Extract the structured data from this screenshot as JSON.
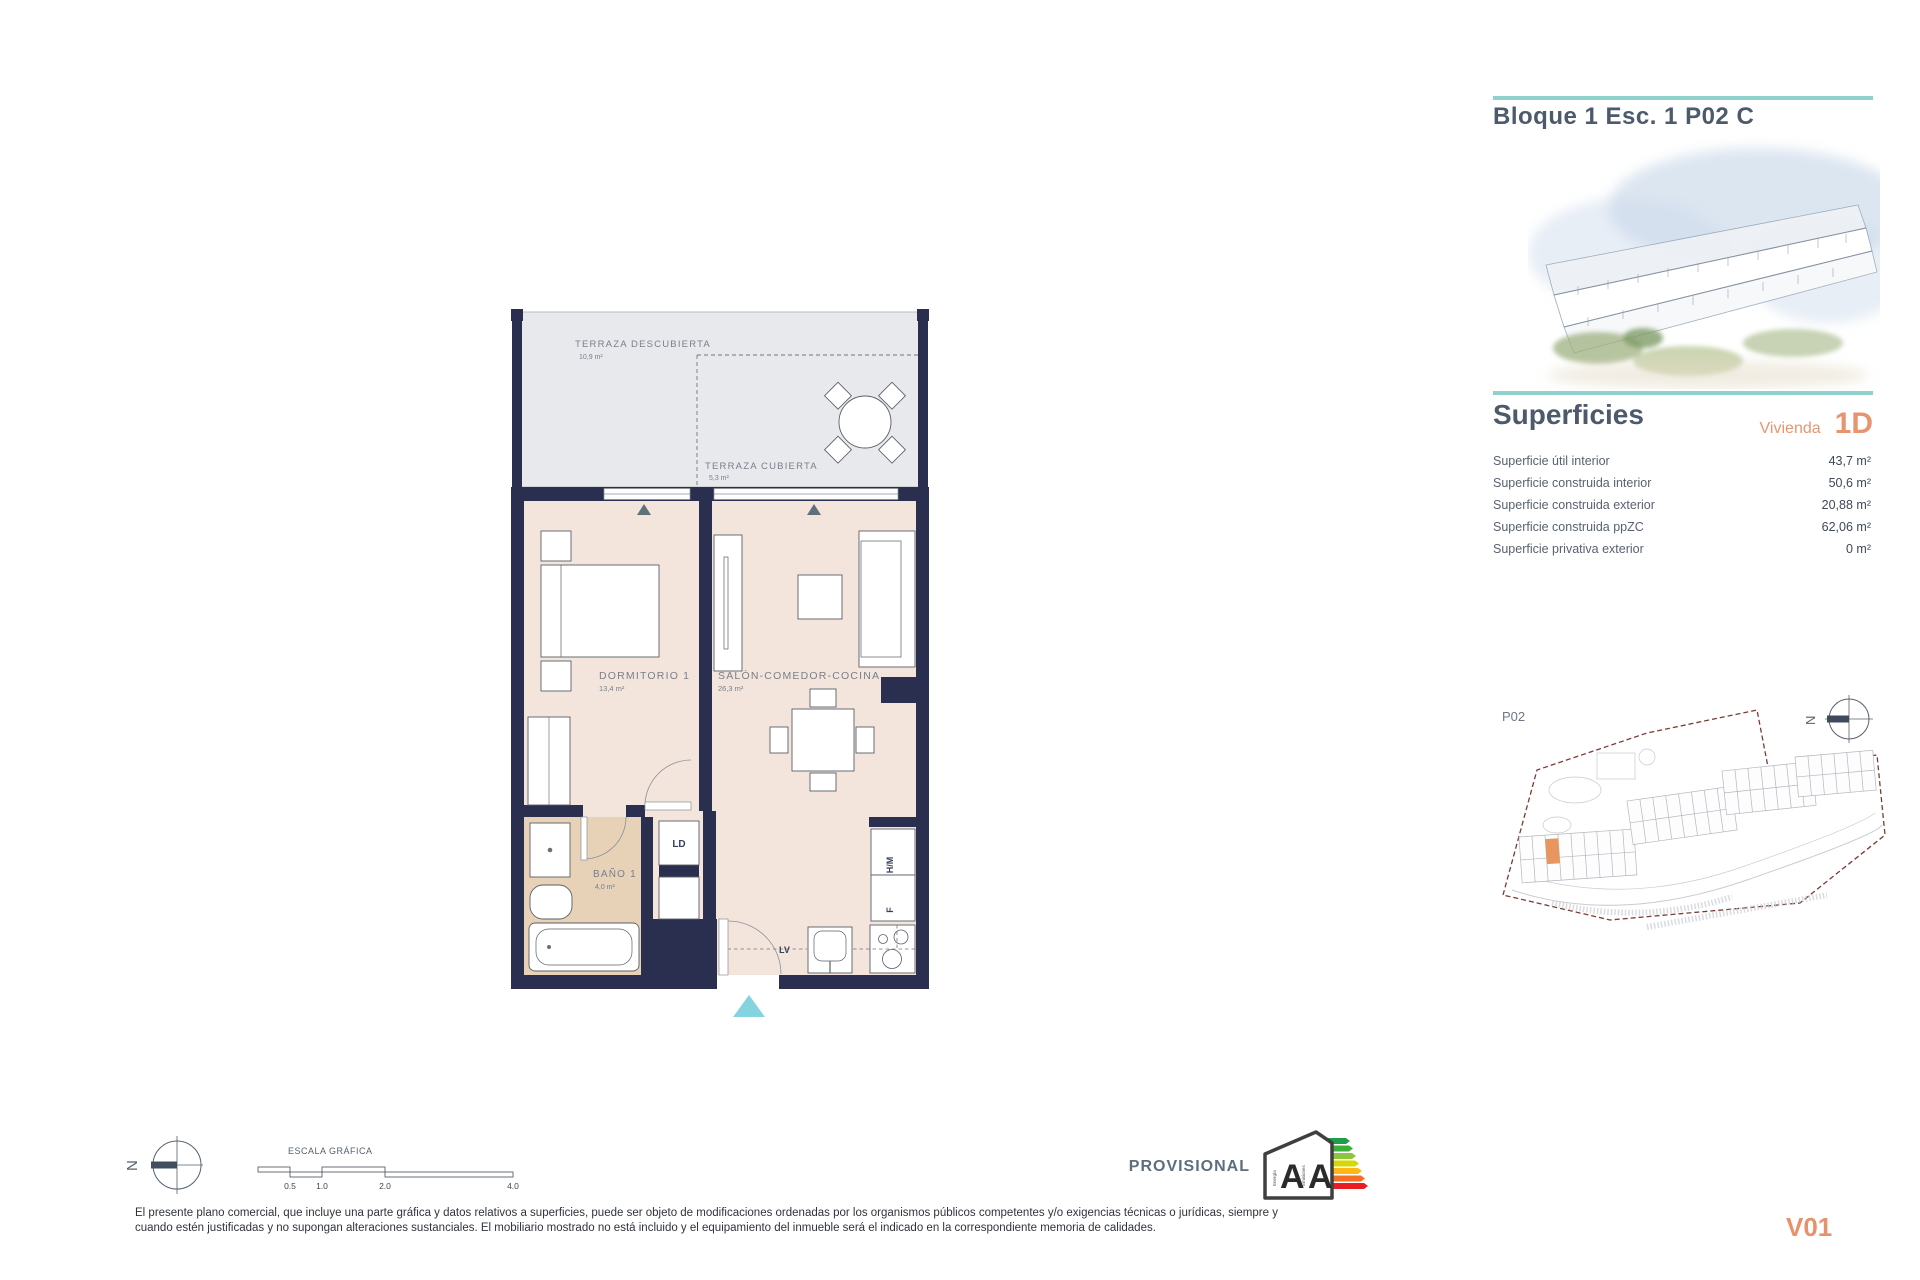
{
  "header": {
    "title": "Bloque 1 Esc. 1 P02 C"
  },
  "superficies": {
    "title": "Superficies",
    "vivienda_label": "Vivienda",
    "vivienda_code": "1D",
    "rows": [
      {
        "label": "Superficie útil interior",
        "value": "43,7 m²"
      },
      {
        "label": "Superficie construida interior",
        "value": "50,6 m²"
      },
      {
        "label": "Superficie construida exterior",
        "value": "20,88 m²"
      },
      {
        "label": "Superficie construida ppZC",
        "value": "62,06 m²"
      },
      {
        "label": "Superficie privativa exterior",
        "value": "0 m²"
      }
    ]
  },
  "floor_plan": {
    "rooms": [
      {
        "name": "TERRAZA DESCUBIERTA",
        "area": "10,9 m²"
      },
      {
        "name": "TERRAZA CUBIERTA",
        "area": "5,3 m²"
      },
      {
        "name": "DORMITORIO 1",
        "area": "13,4 m²"
      },
      {
        "name": "SALÓN-COMEDOR-COCINA",
        "area": "26,3 m²"
      },
      {
        "name": "BAÑO 1",
        "area": "4,0 m²"
      }
    ],
    "labels": {
      "ld": "LD",
      "hm": "H/M",
      "f": "F",
      "lv": "LV"
    }
  },
  "site_plan": {
    "floor_label": "P02",
    "north_letter": "N"
  },
  "scale_bar": {
    "title": "ESCALA GRÁFICA",
    "ticks": [
      "0.5",
      "1.0",
      "2.0",
      "4.0"
    ]
  },
  "compass": {
    "north_letter": "N"
  },
  "energy_label": {
    "provisional": "PROVISIONAL",
    "rating_letters": [
      "A",
      "A"
    ],
    "axis_labels": [
      "Energía",
      "Emisiones"
    ],
    "bar_colors": [
      "#1f9d49",
      "#3fae37",
      "#8cc63f",
      "#d6d800",
      "#fdb813",
      "#f36f21",
      "#ea1d25"
    ]
  },
  "disclaimer": {
    "line1": "El presente plano comercial, que incluye una parte gráfica y datos relativos a superficies, puede ser objeto de modificaciones ordenadas por los organismos públicos competentes y/o exigencias técnicas o jurídicas, siempre y",
    "line2": "cuando estén justificadas y no supongan alteraciones sustanciales. El mobiliario mostrado no está incluido y el equipamiento del inmueble será el indicado en la correspondiente memoria de calidades."
  },
  "version": "V01",
  "colors": {
    "accent_teal": "#8fd2cd",
    "accent_orange": "#e8946e",
    "wall_navy": "#2a2f4f",
    "floor_beige": "#f3e5dc",
    "bath_tan": "#e7d2b8",
    "terrace_gray": "#e8e9ec",
    "boundary_red": "#7a3b35",
    "entrance_cyan": "#84d3de",
    "title_slate": "#4d5a6c"
  }
}
